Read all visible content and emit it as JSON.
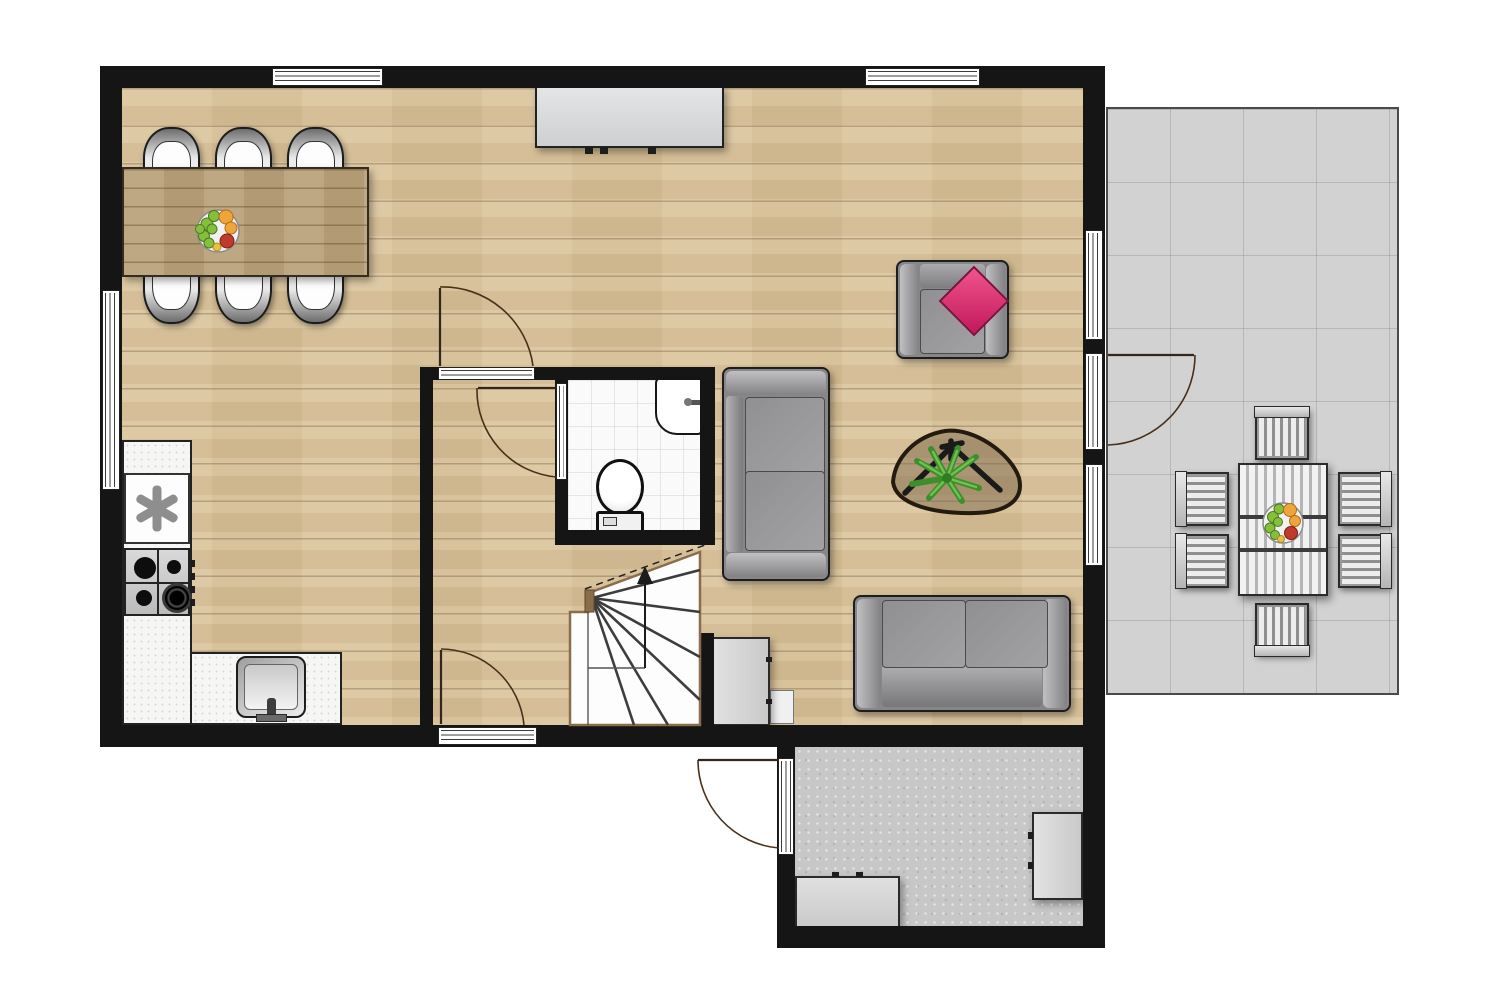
{
  "title": "ground-floor-plan",
  "canvas": {
    "width": 1500,
    "height": 999,
    "background": "#ffffff"
  },
  "palette": {
    "wall": "#151515",
    "wood_floor": "#d8c096",
    "dining_table": "#b9a17a",
    "terrace_floor": "#d2d2d2",
    "shed_floor": "#c7c7c7",
    "bathroom_tile": "#fafafa",
    "counter_white": "#f6f6f4",
    "furniture_gray": "#87878a",
    "cabinet_gray": "#d9d9d9",
    "sideboard_gray": "#d8dadc",
    "pillow_pink": "#e0356e",
    "plant_green": "#3c8f2b",
    "stair_wood": "#8a6d4a",
    "door_arc": "#4a3019",
    "window_white": "#ffffff"
  },
  "rooms": [
    {
      "name": "living-dining-area",
      "floor": "wood"
    },
    {
      "name": "kitchen",
      "floor": "wood"
    },
    {
      "name": "hallway",
      "floor": "wood"
    },
    {
      "name": "bathroom",
      "floor": "white-tile"
    },
    {
      "name": "storage-shed",
      "floor": "concrete"
    },
    {
      "name": "terrace",
      "floor": "gray-tile-grid"
    }
  ],
  "fixtures": {
    "windows": [
      "top-wall-left",
      "top-wall-right",
      "left-wall",
      "right-wall-upper",
      "right-wall-lower"
    ],
    "glazed_doors": [
      "hallway-back-door",
      "terrace-door",
      "shed-door"
    ],
    "interior_door_swings": [
      "hallway-to-living",
      "hallway-to-bathroom"
    ],
    "staircase": "winder-stairs-up-arrow"
  },
  "furniture": [
    "dining-table",
    "dining-chairs-x6",
    "fruit-bowl-on-dining-table",
    "sideboard",
    "armchair-with-pink-cushion",
    "two-seat-sofa-left",
    "two-seat-sofa-bottom",
    "organic-coffee-table-with-plant",
    "small-cabinet-by-stairs",
    "small-white-unit",
    "kitchen-counter-with-appliance-and-hob",
    "kitchen-sink",
    "bathroom-hand-basin",
    "toilet",
    "shed-cabinet-bottom",
    "shed-cabinet-right",
    "outdoor-dining-table",
    "garden-chairs-x6",
    "fruit-bowl-on-outdoor-table"
  ]
}
